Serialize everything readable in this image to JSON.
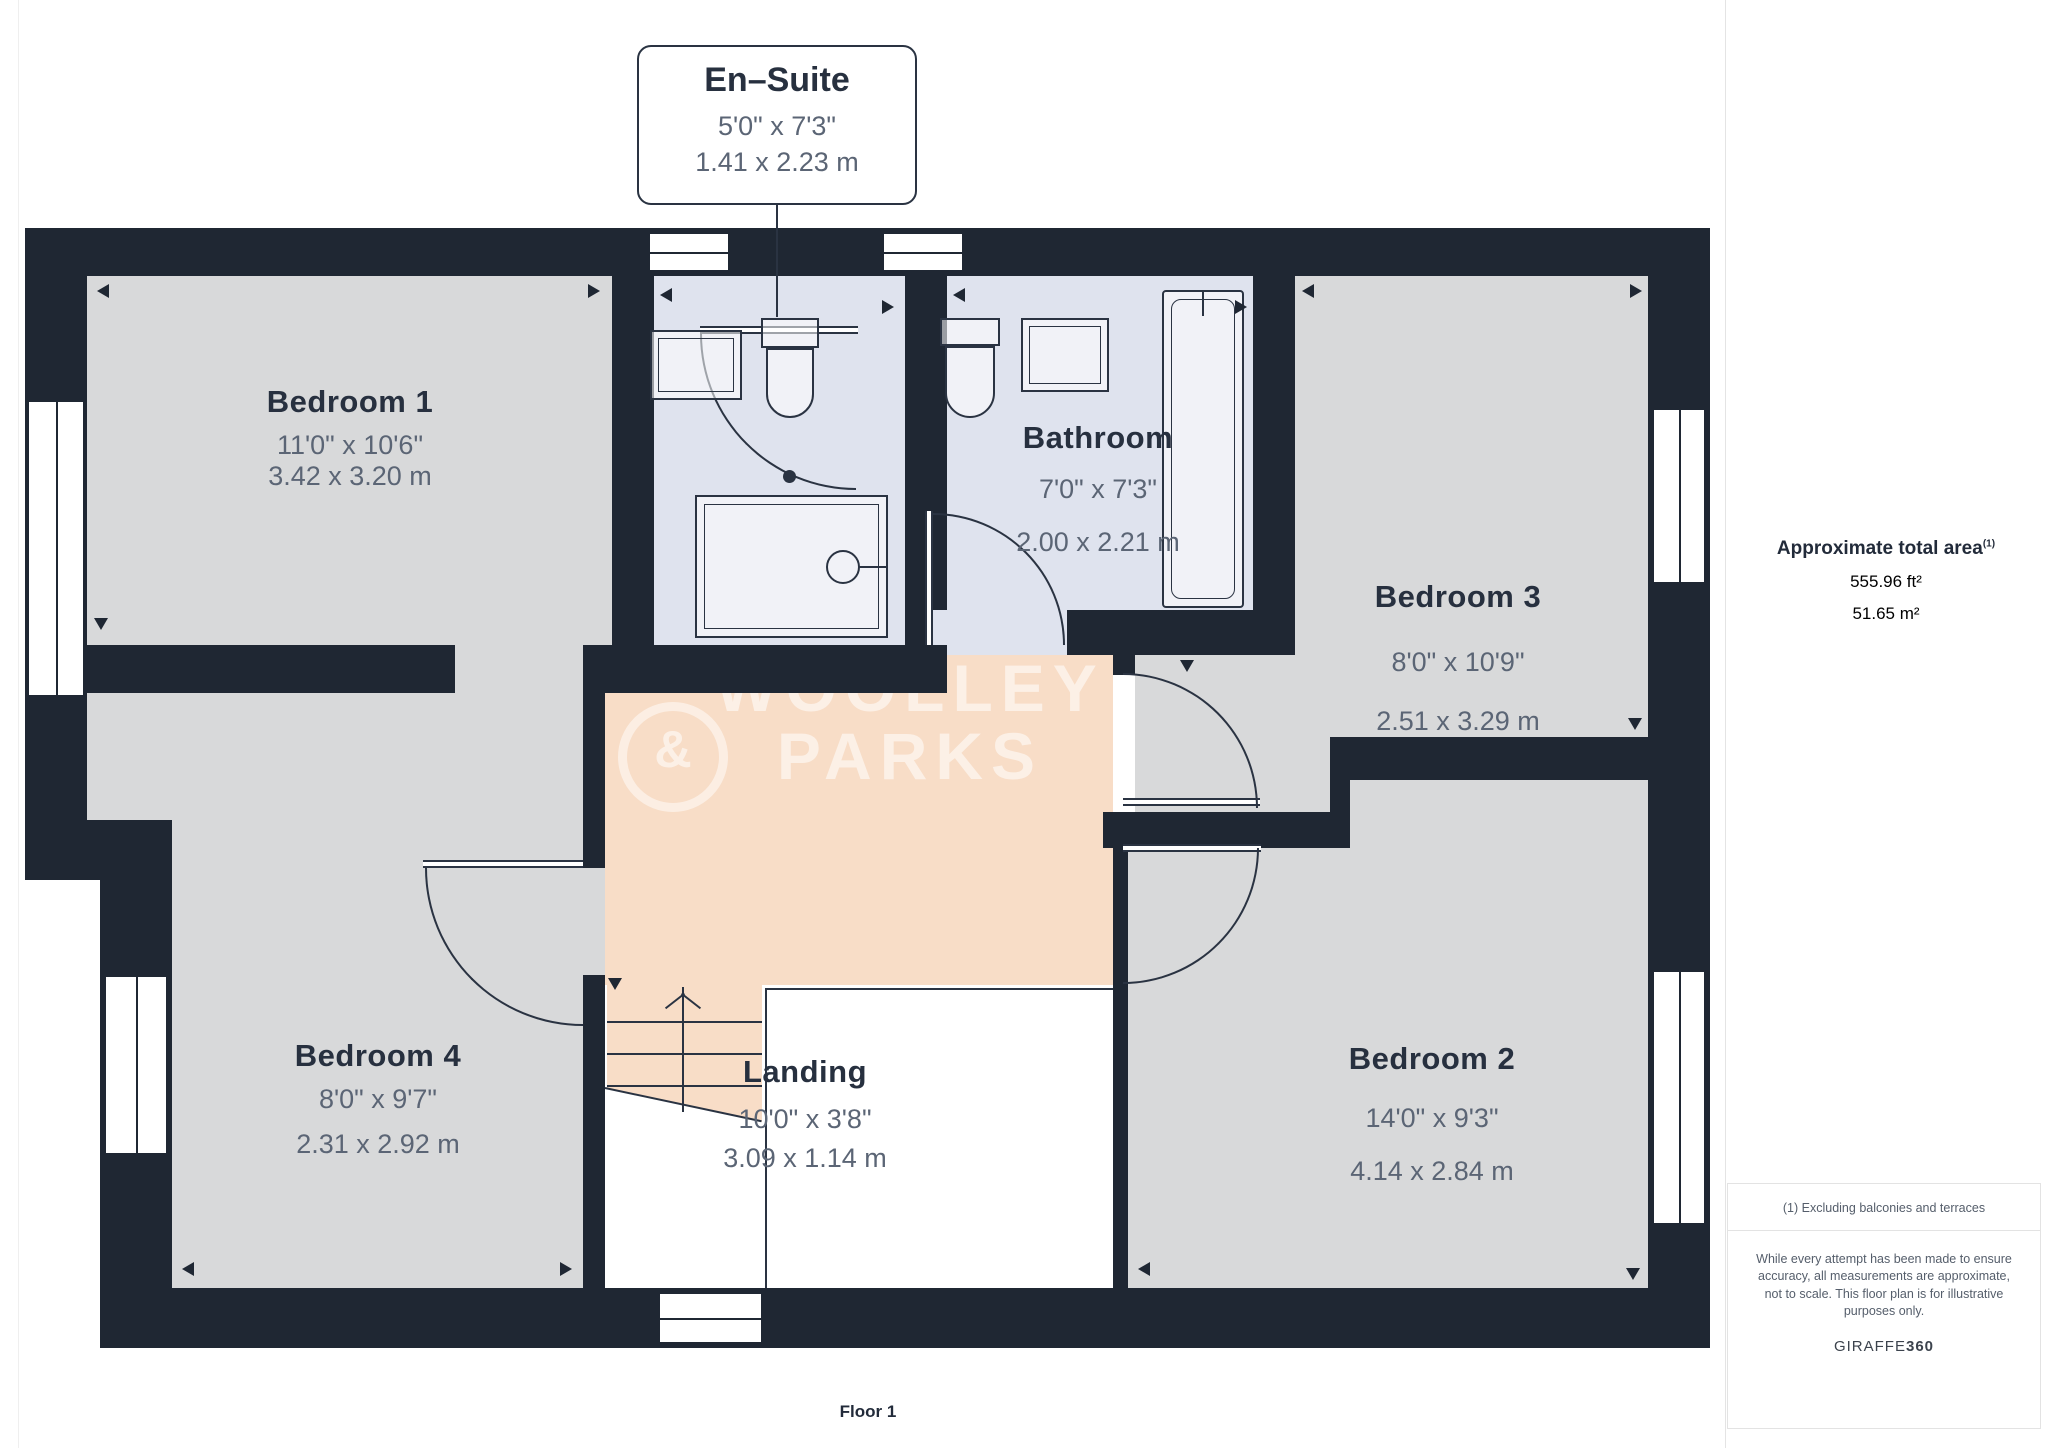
{
  "colors": {
    "wall": "#1f2733",
    "room": "#d8d9da",
    "bath": "#dfe3ee",
    "landing": "#f8ddc7",
    "line": "#2a3342",
    "title": "#27303f",
    "dim": "#5b6575"
  },
  "callout": {
    "title": "En–Suite",
    "dim_imperial": "5'0\" x 7'3\"",
    "dim_metric": "1.41 x 2.23 m"
  },
  "rooms": [
    {
      "name": "Bedroom 1",
      "dim_imperial": "11'0\" x 10'6\"",
      "dim_metric": "3.42 x 3.20 m"
    },
    {
      "name": "Bathroom",
      "dim_imperial": "7'0\" x 7'3\"",
      "dim_metric": "2.00 x 2.21 m"
    },
    {
      "name": "Bedroom 3",
      "dim_imperial": "8'0\" x 10'9\"",
      "dim_metric": "2.51 x 3.29 m"
    },
    {
      "name": "Bedroom 4",
      "dim_imperial": "8'0\" x 9'7\"",
      "dim_metric": "2.31 x 2.92 m"
    },
    {
      "name": "Landing",
      "dim_imperial": "10'0\" x 3'8\"",
      "dim_metric": "3.09 x 1.14 m"
    },
    {
      "name": "Bedroom 2",
      "dim_imperial": "14'0\" x 9'3\"",
      "dim_metric": "4.14 x 2.84 m"
    }
  ],
  "watermark": {
    "logo": "&",
    "line1": "WOOLLEY",
    "line2": "PARKS"
  },
  "sidebar": {
    "area_title": "Approximate total area",
    "area_superscript": "(1)",
    "area_ft": "555.96 ft²",
    "area_m": "51.65 m²",
    "footnote": "(1) Excluding balconies and terraces",
    "disclaimer": "While every attempt has been made to ensure accuracy, all measurements are approximate, not to scale. This floor plan is for illustrative purposes only.",
    "brand": "GIRAFFE",
    "brand_suffix": "360"
  },
  "floor_label": "Floor 1"
}
